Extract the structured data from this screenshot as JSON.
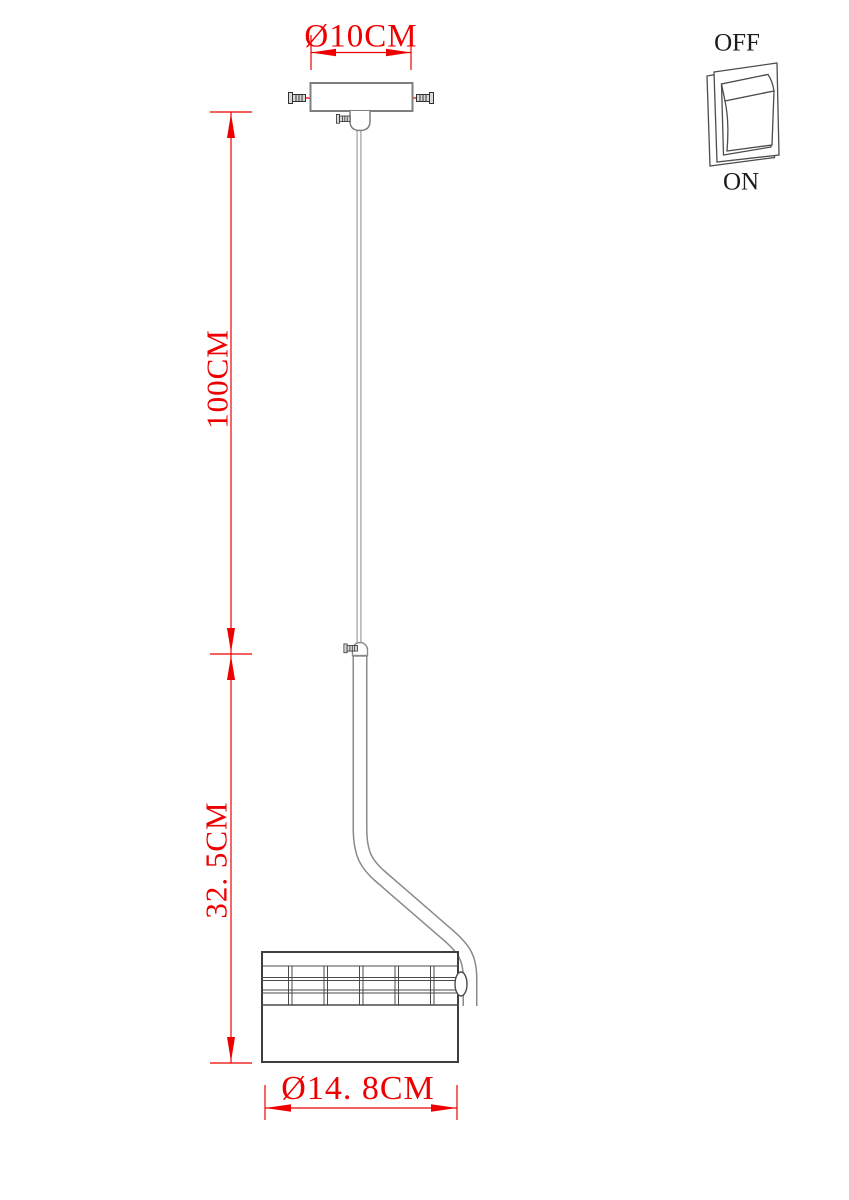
{
  "diagram": {
    "type": "pendant-lamp-dimension-drawing",
    "dimensions": {
      "canopy_diameter": "Ø10CM",
      "suspension_length": "100CM",
      "fixture_drop": "32. 5CM",
      "shade_diameter": "Ø14. 8CM"
    },
    "switch": {
      "off_label": "OFF",
      "on_label": "ON"
    },
    "colors": {
      "dim-red": "#ee0000",
      "line-gray": "#7f7f7f",
      "line-light": "#9c9c9c",
      "line-rod": "#8a8a8a",
      "line-dark": "#3f3f3f",
      "switch-line": "#4d4d4d",
      "text-black": "#1c1c1c",
      "background": "#ffffff"
    },
    "icons": {
      "screw": "side-view machine screw with slotted head and threaded shaft",
      "rocker-switch": "3d perspective rocker switch, top pressed out (OFF position shown)"
    }
  }
}
